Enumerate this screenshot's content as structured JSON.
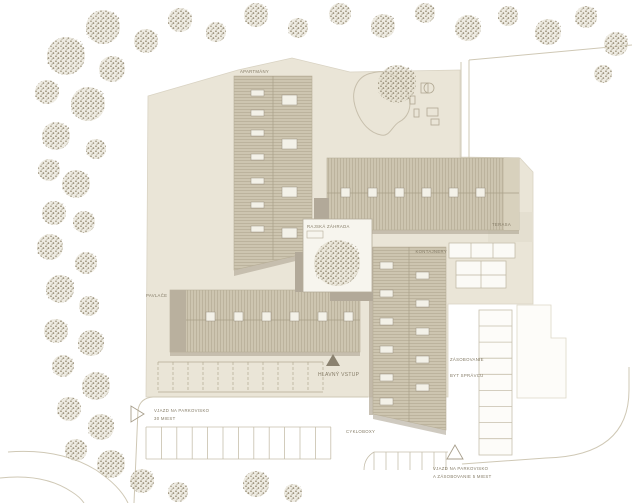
{
  "type": "architectural-site-plan",
  "labels": {
    "apartments": "APARTMÁNY",
    "gallery": "PAVLAČE",
    "paradise_garden": "RAJSKÁ ZÁHRADA",
    "terrace": "TERASA",
    "containers": "KONTAJNERY",
    "supply": "ZÁSOBOVANIE",
    "caretaker_flat": "BYT SPRÁVCU",
    "main_entrance": "HLAVNÝ VSTUP",
    "bike_boxes": "CYKLOBOXY",
    "parking_entry_left": {
      "line1": "VJAZD NA PARKOVISKO",
      "line2": "30 MIEST"
    },
    "parking_entry_right": {
      "line1": "VJAZD NA PARKOVISKO",
      "line2": "A ZÁSOBOVANIE 5 MIEST"
    }
  },
  "colors": {
    "ground": "#eae5d7",
    "roof": "#cdc5b0",
    "roof_hatch": "#b5ac95",
    "shadow": "#a89f8c",
    "connector": "#b2a999",
    "courtyard": "#f7f5ee",
    "terrace_pave": "#e4dfd0",
    "outline": "#d6d0bf",
    "tree_dot": "#a49b85",
    "label_text": "#847b66"
  },
  "trees": [
    [
      103,
      27,
      17
    ],
    [
      146,
      41,
      12
    ],
    [
      66,
      56,
      19
    ],
    [
      112,
      69,
      13
    ],
    [
      47,
      92,
      12
    ],
    [
      88,
      104,
      17
    ],
    [
      56,
      136,
      14
    ],
    [
      96,
      149,
      10
    ],
    [
      49,
      170,
      11
    ],
    [
      76,
      184,
      14
    ],
    [
      54,
      213,
      12
    ],
    [
      84,
      222,
      11
    ],
    [
      50,
      247,
      13
    ],
    [
      86,
      263,
      11
    ],
    [
      60,
      289,
      14
    ],
    [
      89,
      306,
      10
    ],
    [
      56,
      331,
      12
    ],
    [
      91,
      343,
      13
    ],
    [
      63,
      366,
      11
    ],
    [
      96,
      386,
      14
    ],
    [
      69,
      409,
      12
    ],
    [
      101,
      427,
      13
    ],
    [
      76,
      450,
      11
    ],
    [
      111,
      464,
      14
    ],
    [
      142,
      481,
      12
    ],
    [
      178,
      492,
      10
    ],
    [
      180,
      20,
      12
    ],
    [
      216,
      32,
      10
    ],
    [
      256,
      15,
      12
    ],
    [
      298,
      28,
      10
    ],
    [
      340,
      14,
      11
    ],
    [
      383,
      26,
      12
    ],
    [
      425,
      13,
      10
    ],
    [
      468,
      28,
      13
    ],
    [
      508,
      16,
      10
    ],
    [
      548,
      32,
      13
    ],
    [
      586,
      17,
      11
    ],
    [
      616,
      44,
      12
    ],
    [
      603,
      74,
      9
    ],
    [
      397,
      84,
      19
    ],
    [
      337,
      263,
      23
    ],
    [
      256,
      484,
      13
    ],
    [
      293,
      493,
      9
    ]
  ]
}
